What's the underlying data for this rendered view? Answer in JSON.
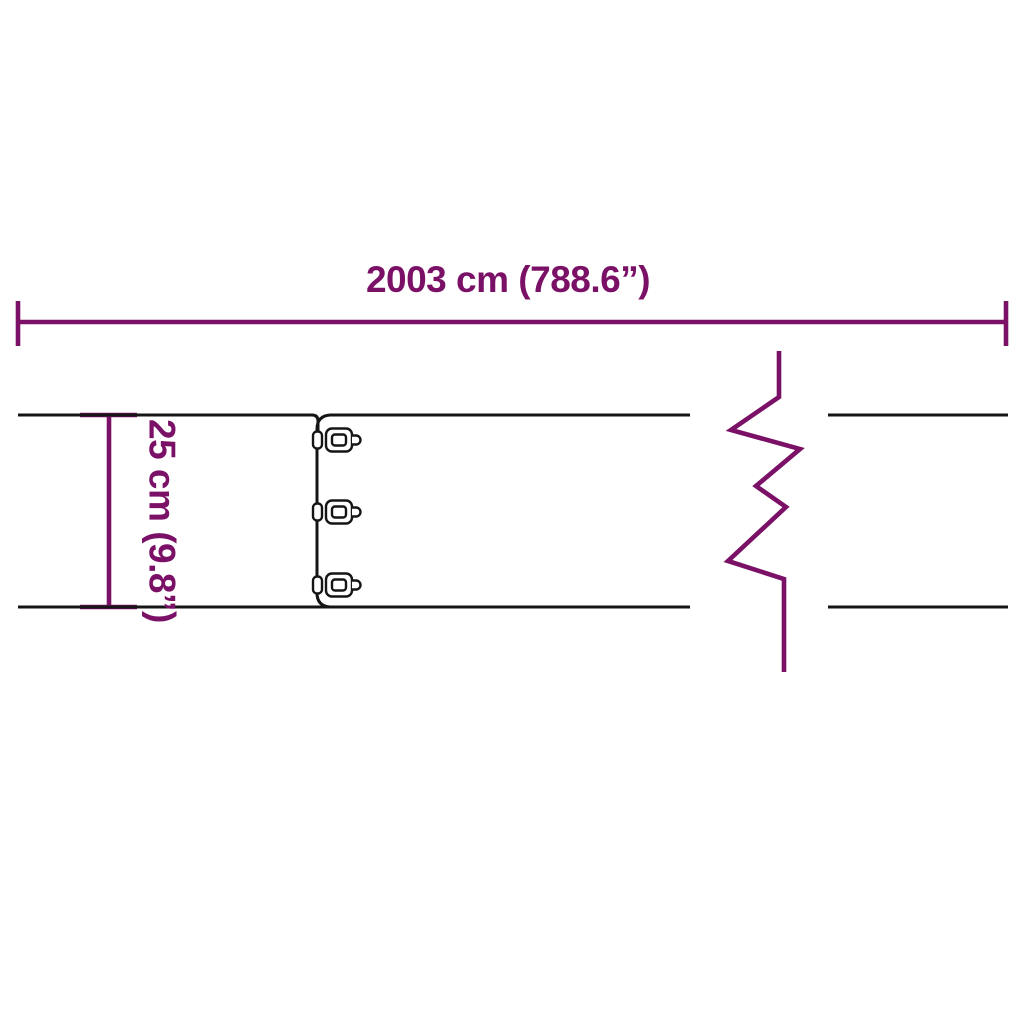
{
  "diagram": {
    "type": "product-dimension-diagram",
    "subject": "lawn edging strip with connector clips and break symbol",
    "width_label": "2003 cm (788.6”)",
    "height_label": "25 cm (9.8”)",
    "colors": {
      "dimension": "#7a1167",
      "drawing": "#151515",
      "background": "#ffffff"
    }
  }
}
